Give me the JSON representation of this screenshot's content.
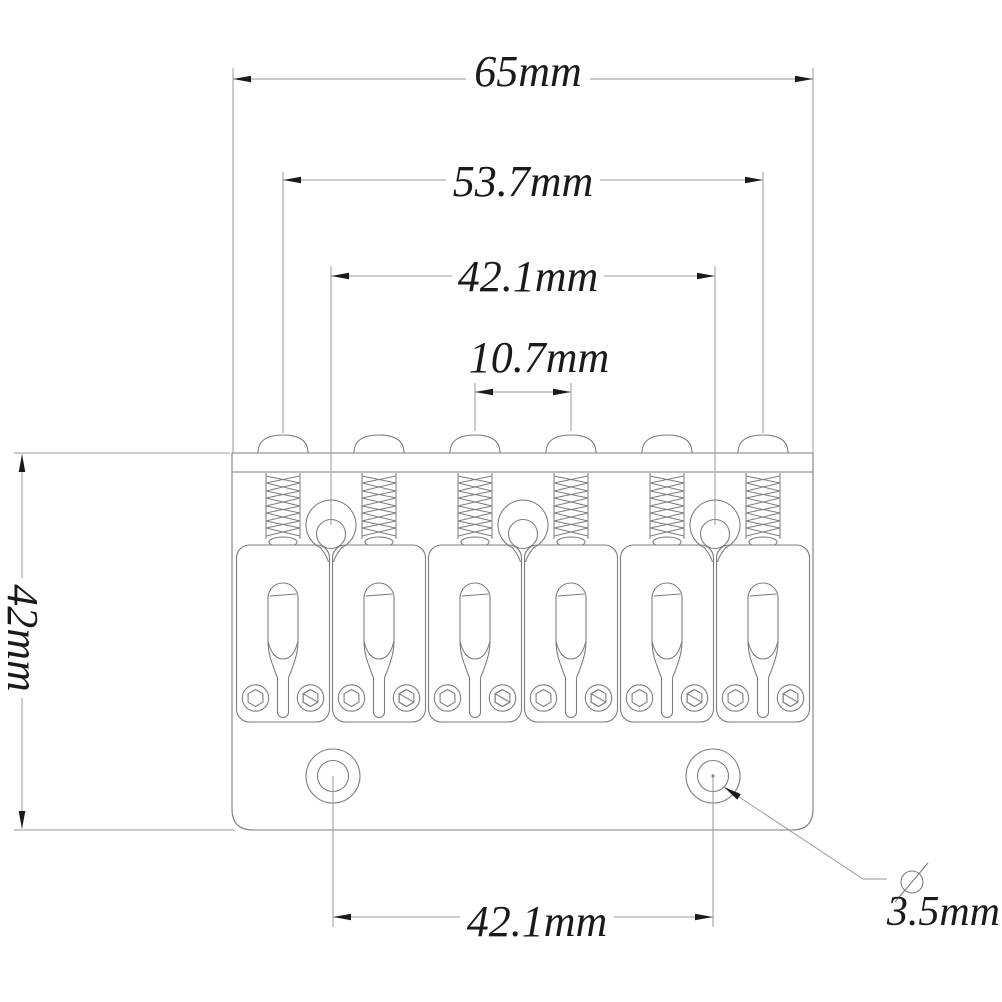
{
  "drawing": {
    "type": "guitar-hardtail-bridge-dimension-drawing",
    "background": "#ffffff",
    "colors": {
      "part_line": "#7d7d7d",
      "dimension_line": "#9a9a9a",
      "text": "#1a1a1a"
    },
    "labels": {
      "overall_width": "65mm",
      "saddle_spread": "53.7mm",
      "screw_spacing_top": "42.1mm",
      "string_spacing": "10.7mm",
      "depth": "42mm",
      "screw_spacing_bottom": "42.1mm",
      "hole_diameter": "3.5mm"
    },
    "features": {
      "saddle_count": 6,
      "mount_ring_count": 3,
      "bottom_hole_count": 2
    }
  }
}
